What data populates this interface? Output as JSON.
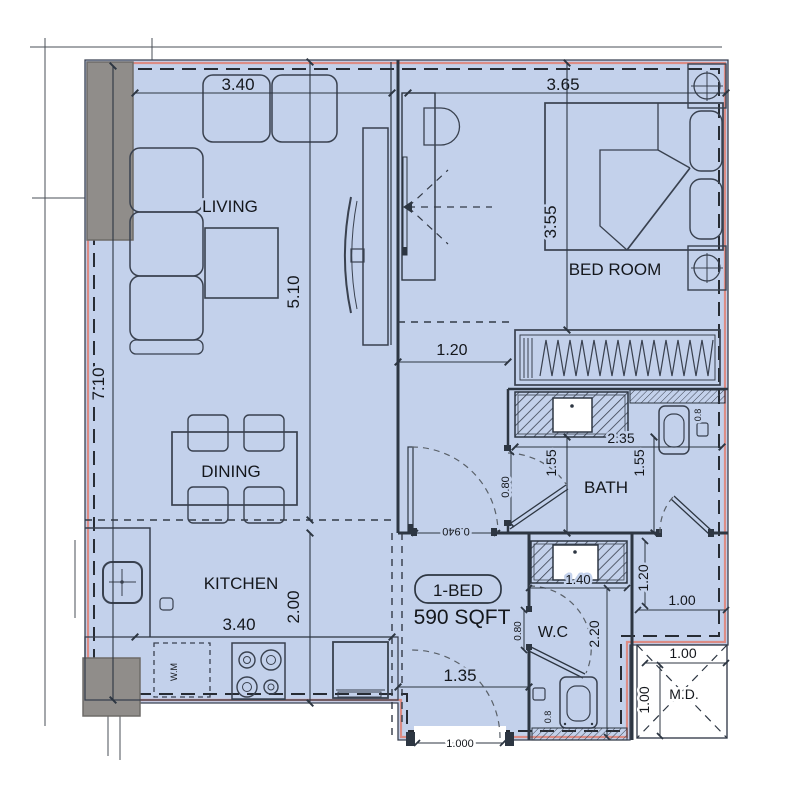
{
  "plan": {
    "unit": {
      "type_label": "1-BED",
      "area_label": "590 SQFT"
    },
    "rooms": {
      "living": "LIVING",
      "dining": "DINING",
      "kitchen": "KITCHEN",
      "bedroom": "BED ROOM",
      "bath": "BATH",
      "wc": "W.C",
      "md_shaft": "M.D."
    },
    "appliances": {
      "washing_machine": "W.M"
    },
    "dimensions": {
      "living_width": "3.40",
      "bedroom_width": "3.65",
      "living_length": "5.10",
      "left_side": "7.10",
      "bedroom_depth": "3.55",
      "corridor_width": "1.20",
      "bath_width": "2.35",
      "bath_left": "1.55",
      "bath_right": "1.55",
      "bath_door": "0.80",
      "vanity_width": "1.40",
      "passage_height": "1.20",
      "passage_width": "1.00",
      "wc_length": "2.20",
      "wc_door": "0.80",
      "entry_width": "1.35",
      "entry_opening": "1.000",
      "corridor_door": "0.940",
      "md_width": "1.00",
      "md_height": "1.00",
      "kitchen_width": "3.40",
      "kitchen_depth": "2.00",
      "bath_toilet_width": "0.8",
      "wc_toilet_width": "0.8"
    },
    "colors": {
      "unit_fill": "#c3d1eb",
      "boundary_highlight": "#dc8c85",
      "line": "#2d3642",
      "column_fill": "#908d8a"
    }
  }
}
